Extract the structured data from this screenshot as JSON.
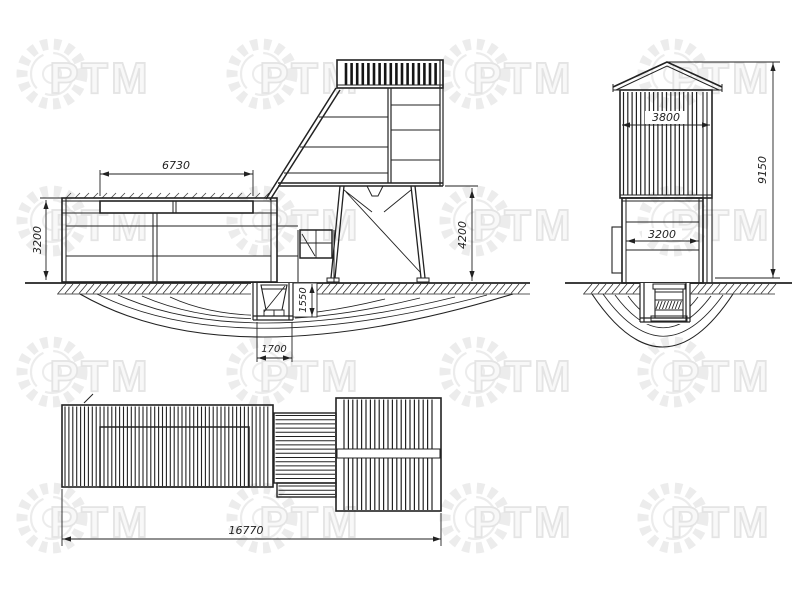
{
  "watermark": {
    "text": "РТМ"
  },
  "views": {
    "front": {
      "dims": {
        "roof_box_length": "6730",
        "wall_height": "3200",
        "support_height": "4200",
        "pit_depth": "1550",
        "pit_width": "1700"
      }
    },
    "side": {
      "dims": {
        "top_width": "3800",
        "base_width": "3200",
        "total_height": "9150"
      }
    },
    "plan": {
      "dims": {
        "total_length": "16770"
      }
    }
  }
}
